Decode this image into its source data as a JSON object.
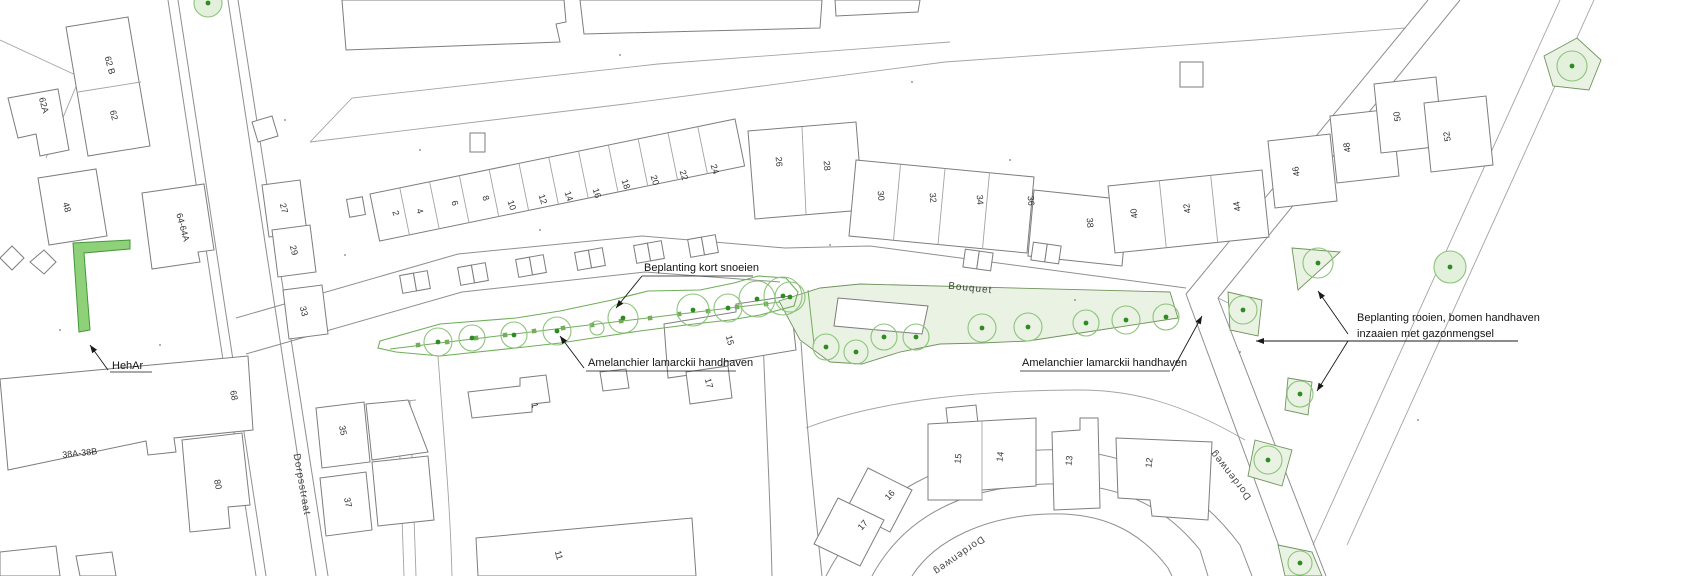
{
  "map": {
    "annotations": {
      "prune": "Beplanting kort snoeien",
      "amelanchier_west": "Amelanchier lamarckii handhaven",
      "amelanchier_east": "Amelanchier lamarckii handhaven",
      "remove_line1": "Beplanting rooien, bomen handhaven",
      "remove_line2": "inzaaien met gazonmengsel",
      "hedge": "HehAr"
    },
    "streets": {
      "west": "Dorpsstraat",
      "main": "Bouquet",
      "east_upper": "Dordenweg",
      "east_lower": "Dordenweg"
    },
    "houses": {
      "west_cluster": [
        "62 B",
        "62A",
        "62",
        "48",
        "64-64A"
      ],
      "dorpsstraat_east": [
        "27",
        "29",
        "33",
        "35",
        "37"
      ],
      "dorpsstraat_west": [
        "68",
        "38A-38B",
        "80"
      ],
      "north_row": [
        "2",
        "4",
        "6",
        "8",
        "10",
        "12",
        "14",
        "16",
        "18",
        "20",
        "22",
        "24"
      ],
      "mid_row": [
        "26",
        "28",
        "30",
        "32",
        "34",
        "36",
        "38"
      ],
      "east_row": [
        "40",
        "42",
        "44",
        "46",
        "48",
        "50",
        "52"
      ],
      "center": [
        "15",
        "17",
        "1",
        "11"
      ],
      "south_row": [
        "15",
        "14",
        "13",
        "12"
      ],
      "south_pair": [
        "16",
        "17"
      ]
    },
    "legend_colors": {
      "planting_keep_fill": "#8ed178",
      "planting_area_fill": "#e9f2e3",
      "tree_outline": "#8cc47a",
      "tree_center": "#2e8b22",
      "parcel_line": "#7d7d7d"
    }
  }
}
